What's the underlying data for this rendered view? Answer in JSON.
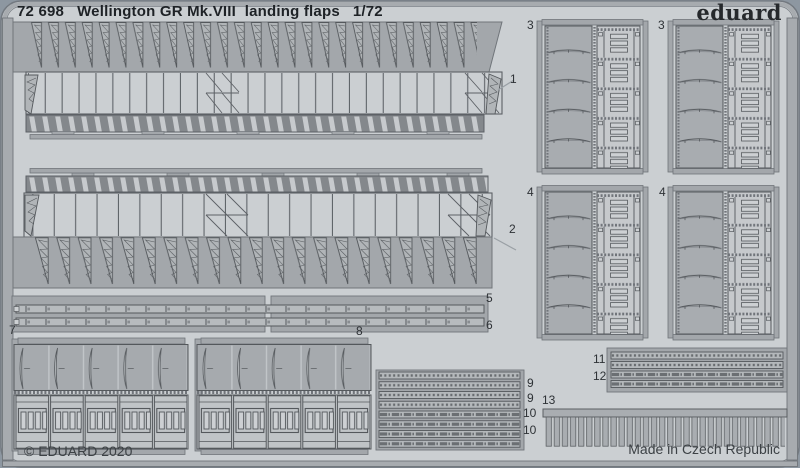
{
  "header": {
    "catalog_number": "72 698",
    "title": "Wellington GR Mk.VIII  landing flaps",
    "scale": "1/72"
  },
  "brand": {
    "logo_text": "eduard"
  },
  "footer": {
    "copyright": "© EDUARD 2020",
    "made_in": "Made in Czech Republic"
  },
  "sheet": {
    "part_labels": {
      "p1": "1",
      "p2": "2",
      "p3a": "3",
      "p3b": "3",
      "p4a": "4",
      "p4b": "4",
      "p5": "5",
      "p6": "6",
      "p7": "7",
      "p8": "8",
      "p9a": "9",
      "p9b": "9",
      "p10a": "10",
      "p10b": "10",
      "p11": "11",
      "p12": "12",
      "p13": "13"
    }
  },
  "colors": {
    "outer_background": "#8d97a1",
    "sheet_background": "#cbcfd2",
    "metal": "#a7abaf",
    "part_light": "#c9cdd0",
    "outline": "#54585c",
    "text": "#1e2226"
  }
}
